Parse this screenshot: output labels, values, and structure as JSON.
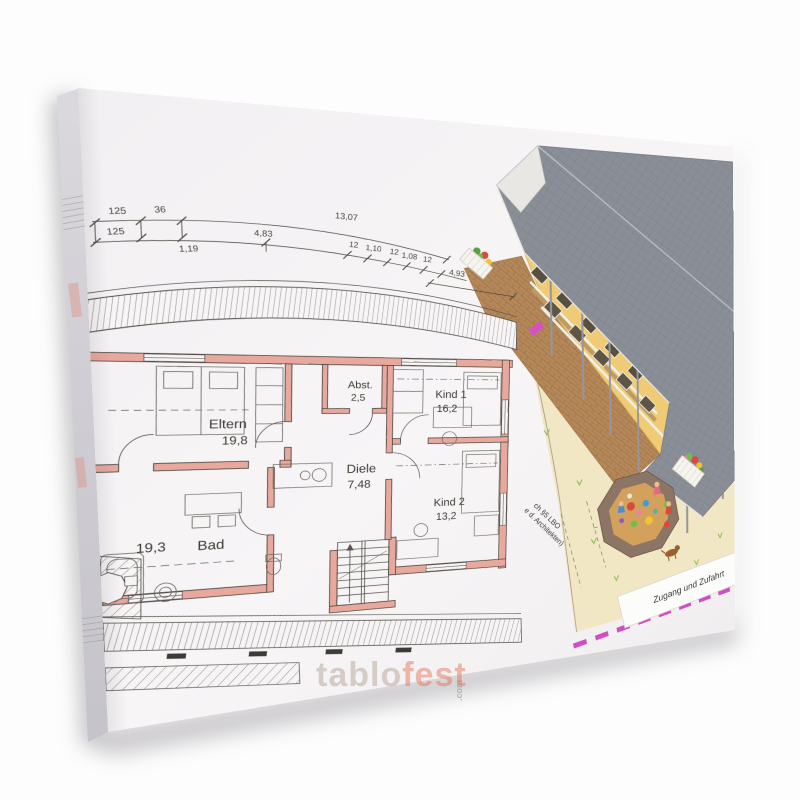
{
  "product_photo": {
    "watermark": {
      "part1": "tablo",
      "part2": "fest",
      "tld": ".com"
    }
  },
  "floor_plan": {
    "dims_row1": [
      "125",
      "36",
      "13,07"
    ],
    "dims_row2": [
      "125",
      "1,19",
      "4,83",
      "12",
      "1,10",
      "12",
      "1,08",
      "12"
    ],
    "dims_row3": [
      "4,93"
    ],
    "rooms": [
      {
        "name": "Eltern",
        "area": "19,8"
      },
      {
        "name": "Abst.",
        "area": "2,5"
      },
      {
        "name": "Kind 1",
        "area": "16,2"
      },
      {
        "name": "Diele",
        "area": "7,48"
      },
      {
        "name": "Kind 2",
        "area": "13,2"
      },
      {
        "name": "Bad",
        "area": "19,3"
      }
    ],
    "annotations": {
      "lbo_line1": "ch §5 LBO",
      "lbo_line2": "e d. Architekten)",
      "access": "Zugang und Zufahrt"
    }
  }
}
